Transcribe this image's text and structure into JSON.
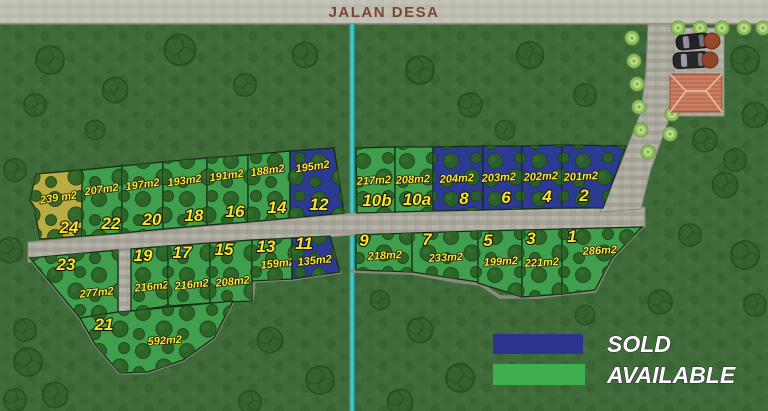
{
  "road": {
    "label": "JALAN DESA"
  },
  "legend": {
    "items": [
      {
        "label": "SOLD",
        "color": "#2e3391"
      },
      {
        "label": "AVAILABLE",
        "color": "#3fae4f"
      }
    ]
  },
  "status_colors": {
    "available": "#3f9f4c",
    "sold": "#2c3a94",
    "reserved": "#b9ac42"
  },
  "plots": {
    "p1": {
      "number": "1",
      "size": "286m2",
      "status": "available"
    },
    "p2": {
      "number": "2",
      "size": "201m2",
      "status": "sold"
    },
    "p3": {
      "number": "3",
      "size": "221m2",
      "status": "available"
    },
    "p4": {
      "number": "4",
      "size": "202m2",
      "status": "sold"
    },
    "p5": {
      "number": "5",
      "size": "199m2",
      "status": "available"
    },
    "p6": {
      "number": "6",
      "size": "203m2",
      "status": "sold"
    },
    "p7": {
      "number": "7",
      "size": "233m2",
      "status": "available"
    },
    "p8": {
      "number": "8",
      "size": "204m2",
      "status": "sold"
    },
    "p9": {
      "number": "9",
      "size": "218m2",
      "status": "available"
    },
    "p10a": {
      "number": "10a",
      "size": "208m2",
      "status": "available"
    },
    "p10b": {
      "number": "10b",
      "size": "217m2",
      "status": "available"
    },
    "p11": {
      "number": "11",
      "size": "135m2",
      "status": "sold"
    },
    "p12": {
      "number": "12",
      "size": "195m2",
      "status": "sold"
    },
    "p13": {
      "number": "13",
      "size": "159m2",
      "status": "available"
    },
    "p14": {
      "number": "14",
      "size": "188m2",
      "status": "available"
    },
    "p15": {
      "number": "15",
      "size": "208m2",
      "status": "available"
    },
    "p16": {
      "number": "16",
      "size": "191m2",
      "status": "available"
    },
    "p17": {
      "number": "17",
      "size": "216m2",
      "status": "available"
    },
    "p18": {
      "number": "18",
      "size": "193m2",
      "status": "available"
    },
    "p19": {
      "number": "19",
      "size": "216m2",
      "status": "available"
    },
    "p20": {
      "number": "20",
      "size": "197m2",
      "status": "available"
    },
    "p21": {
      "number": "21",
      "size": "592m2",
      "status": "available"
    },
    "p22": {
      "number": "22",
      "size": "207m2",
      "status": "available"
    },
    "p23": {
      "number": "23",
      "size": "277m2",
      "status": "available"
    },
    "p24": {
      "number": "24",
      "size": "239 m2",
      "status": "reserved"
    }
  }
}
